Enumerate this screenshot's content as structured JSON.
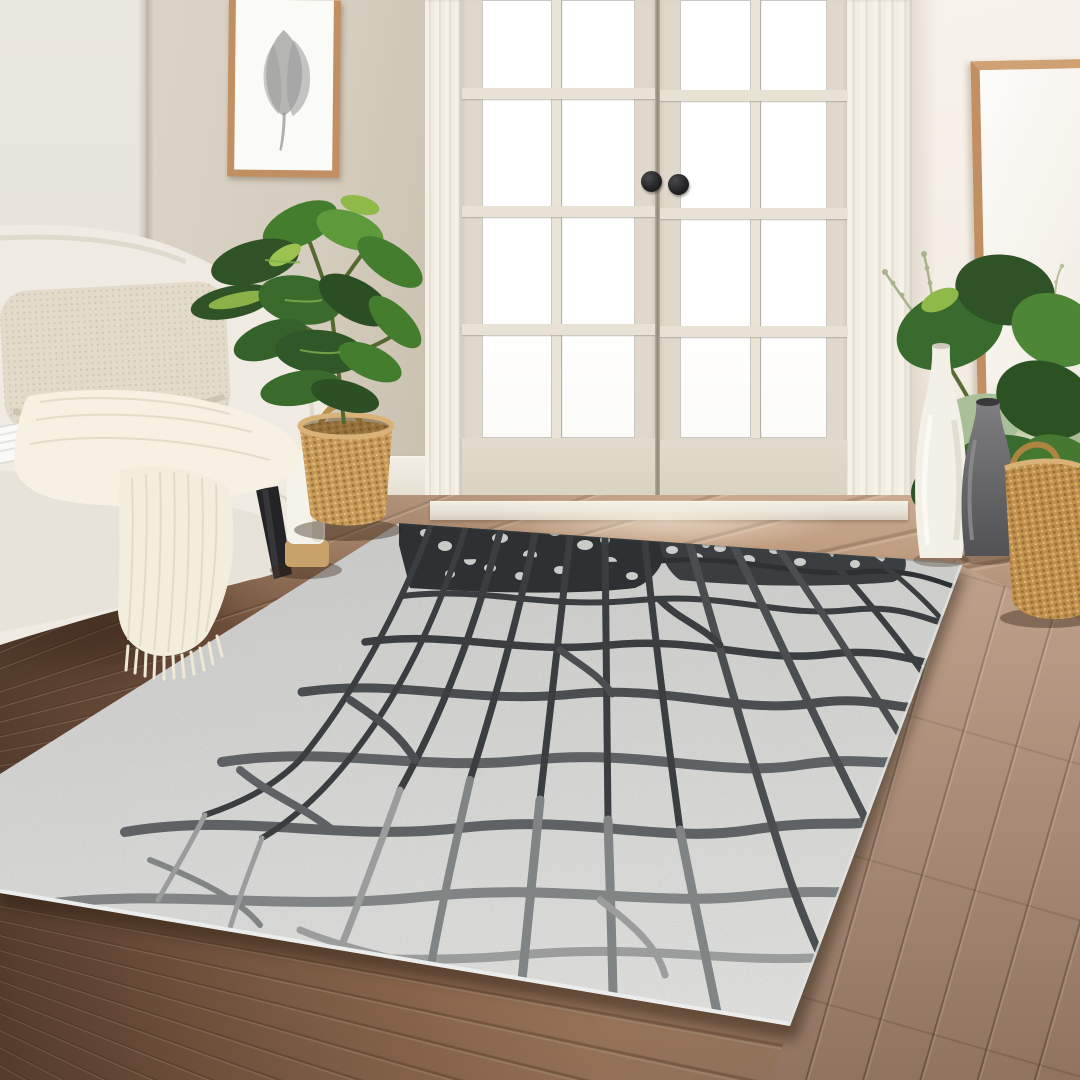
{
  "scene": {
    "setting_label": "Staged living-room product photo of a gray crackle-pattern area rug",
    "objects": {
      "rug": {
        "label": "gray crackle pattern area rug"
      },
      "sofa": {
        "label": "cream upholstered sofa"
      },
      "pillow": {
        "label": "beige woven throw pillow"
      },
      "throw_blanket": {
        "label": "ivory fringed throw blanket"
      },
      "magazine": {
        "label": "open magazine on sofa seat"
      },
      "plant_left": {
        "label": "fiddle leaf plant in wicker basket"
      },
      "basket_left": {
        "label": "woven seagrass basket planter"
      },
      "white_planter": {
        "label": "white planter with wood base"
      },
      "framed_art": {
        "label": "framed gray leaf art print"
      },
      "french_doors": {
        "label": "white french doors with glass panes"
      },
      "door_knob_left": {
        "label": "black round door knob (left door)"
      },
      "door_knob_right": {
        "label": "black round door knob (right door)"
      },
      "mirror": {
        "label": "oak-framed leaning floor mirror"
      },
      "white_vase": {
        "label": "tall white ceramic vase"
      },
      "gray_vase": {
        "label": "gray ceramic vase"
      },
      "dried_sprigs": {
        "label": "dried sage-green sprigs"
      },
      "basket_right": {
        "label": "woven basket with large green plant"
      },
      "plant_right": {
        "label": "large round-leaf green plant"
      },
      "floor": {
        "label": "warm brown wood plank floor"
      },
      "walls": {
        "label": "beige and white walls with baseboard"
      }
    },
    "palette": {
      "wall_left": "#EAE7E0",
      "wall_main": "#D5CDBF",
      "wall_right": "#F4EEE5",
      "trim": "#F2EEE5",
      "door_leaf": "#DFD8CB",
      "sill": "#E9E4D9",
      "floor_dark": "#4F3A2B",
      "floor_mid": "#8A664C",
      "floor_light": "#B38C6D",
      "floor_right": "#AC8B74",
      "rug_base": "#D2D3D1",
      "rug_light": "#DFE0DE",
      "rug_edge": "#ECEDEB",
      "rug_line1": "#2E3133",
      "rug_line2": "#3A3E40",
      "rug_line3": "#4A4E50",
      "rug_line4": "#5E6264",
      "rug_line5": "#808484",
      "rug_line6": "#9A9D9B",
      "sofa": "#EFEBE2",
      "sofa_shade": "#DFD9CC",
      "pillow": "#E2DBC9",
      "pillow_dot": "#C8C0AC",
      "throw": "#F6F1E3",
      "oak": "#C28F63",
      "art_gray": "#9E9E9E",
      "mirror_glass": "#F7F4ED",
      "leaf_dark": "#2F5326",
      "leaf_mid": "#457D2F",
      "leaf_light": "#6FA644",
      "leaf_lime": "#9CC24F",
      "sage": "#A9B289",
      "basket": "#C79A58",
      "basket_dark": "#A47B3F",
      "pot_white": "#F5F2EA",
      "wood_base": "#C9A26B",
      "vase_white": "#F3F0E8",
      "vase_gray_top": "#7E7D7F",
      "vase_gray_bottom": "#525154",
      "knob": "#1F1F22",
      "leg": "#242426"
    }
  }
}
